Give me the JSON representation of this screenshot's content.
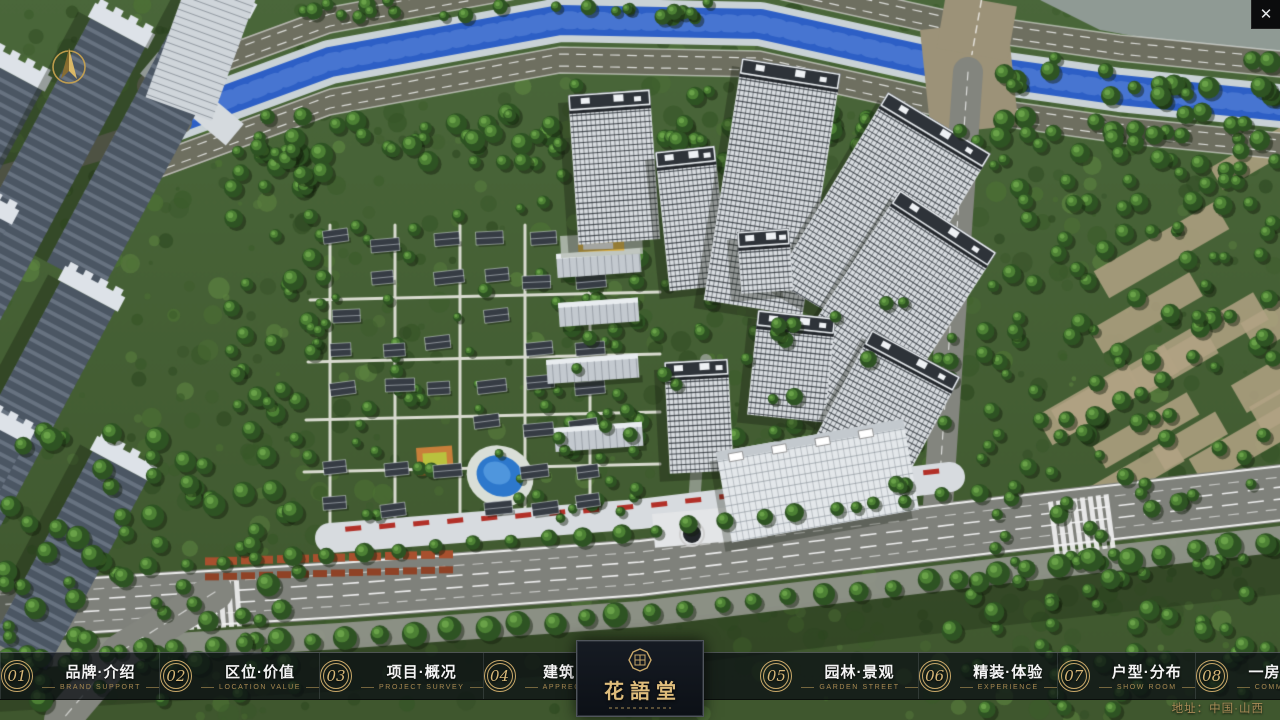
{
  "topbar": {
    "close_glyph": "✕"
  },
  "nav": {
    "items": [
      {
        "num": "01",
        "label": "品牌·介绍",
        "sub": "BRAND SUPPORT"
      },
      {
        "num": "02",
        "label": "区位·价值",
        "sub": "LOCATION VALUE"
      },
      {
        "num": "03",
        "label": "项目·概况",
        "sub": "PROJECT SURVEY"
      },
      {
        "num": "04",
        "label": "建筑·鉴赏",
        "sub": "APPRECIATION"
      },
      {
        "num": "05",
        "label": "园林·景观",
        "sub": "GARDEN STREET"
      },
      {
        "num": "06",
        "label": "精装·体验",
        "sub": "EXPERIENCE"
      },
      {
        "num": "07",
        "label": "户型·分布",
        "sub": "SHOW ROOM"
      },
      {
        "num": "08",
        "label": "一房·一景",
        "sub": "COMMUNITY"
      }
    ]
  },
  "logo": {
    "title": "花語堂"
  },
  "footer": {
    "address": "地址：中国·山西"
  },
  "colors": {
    "gold": "#c9a869",
    "bar_bg": "rgba(10,14,19,0.74)",
    "river": "#2d5fc6"
  }
}
